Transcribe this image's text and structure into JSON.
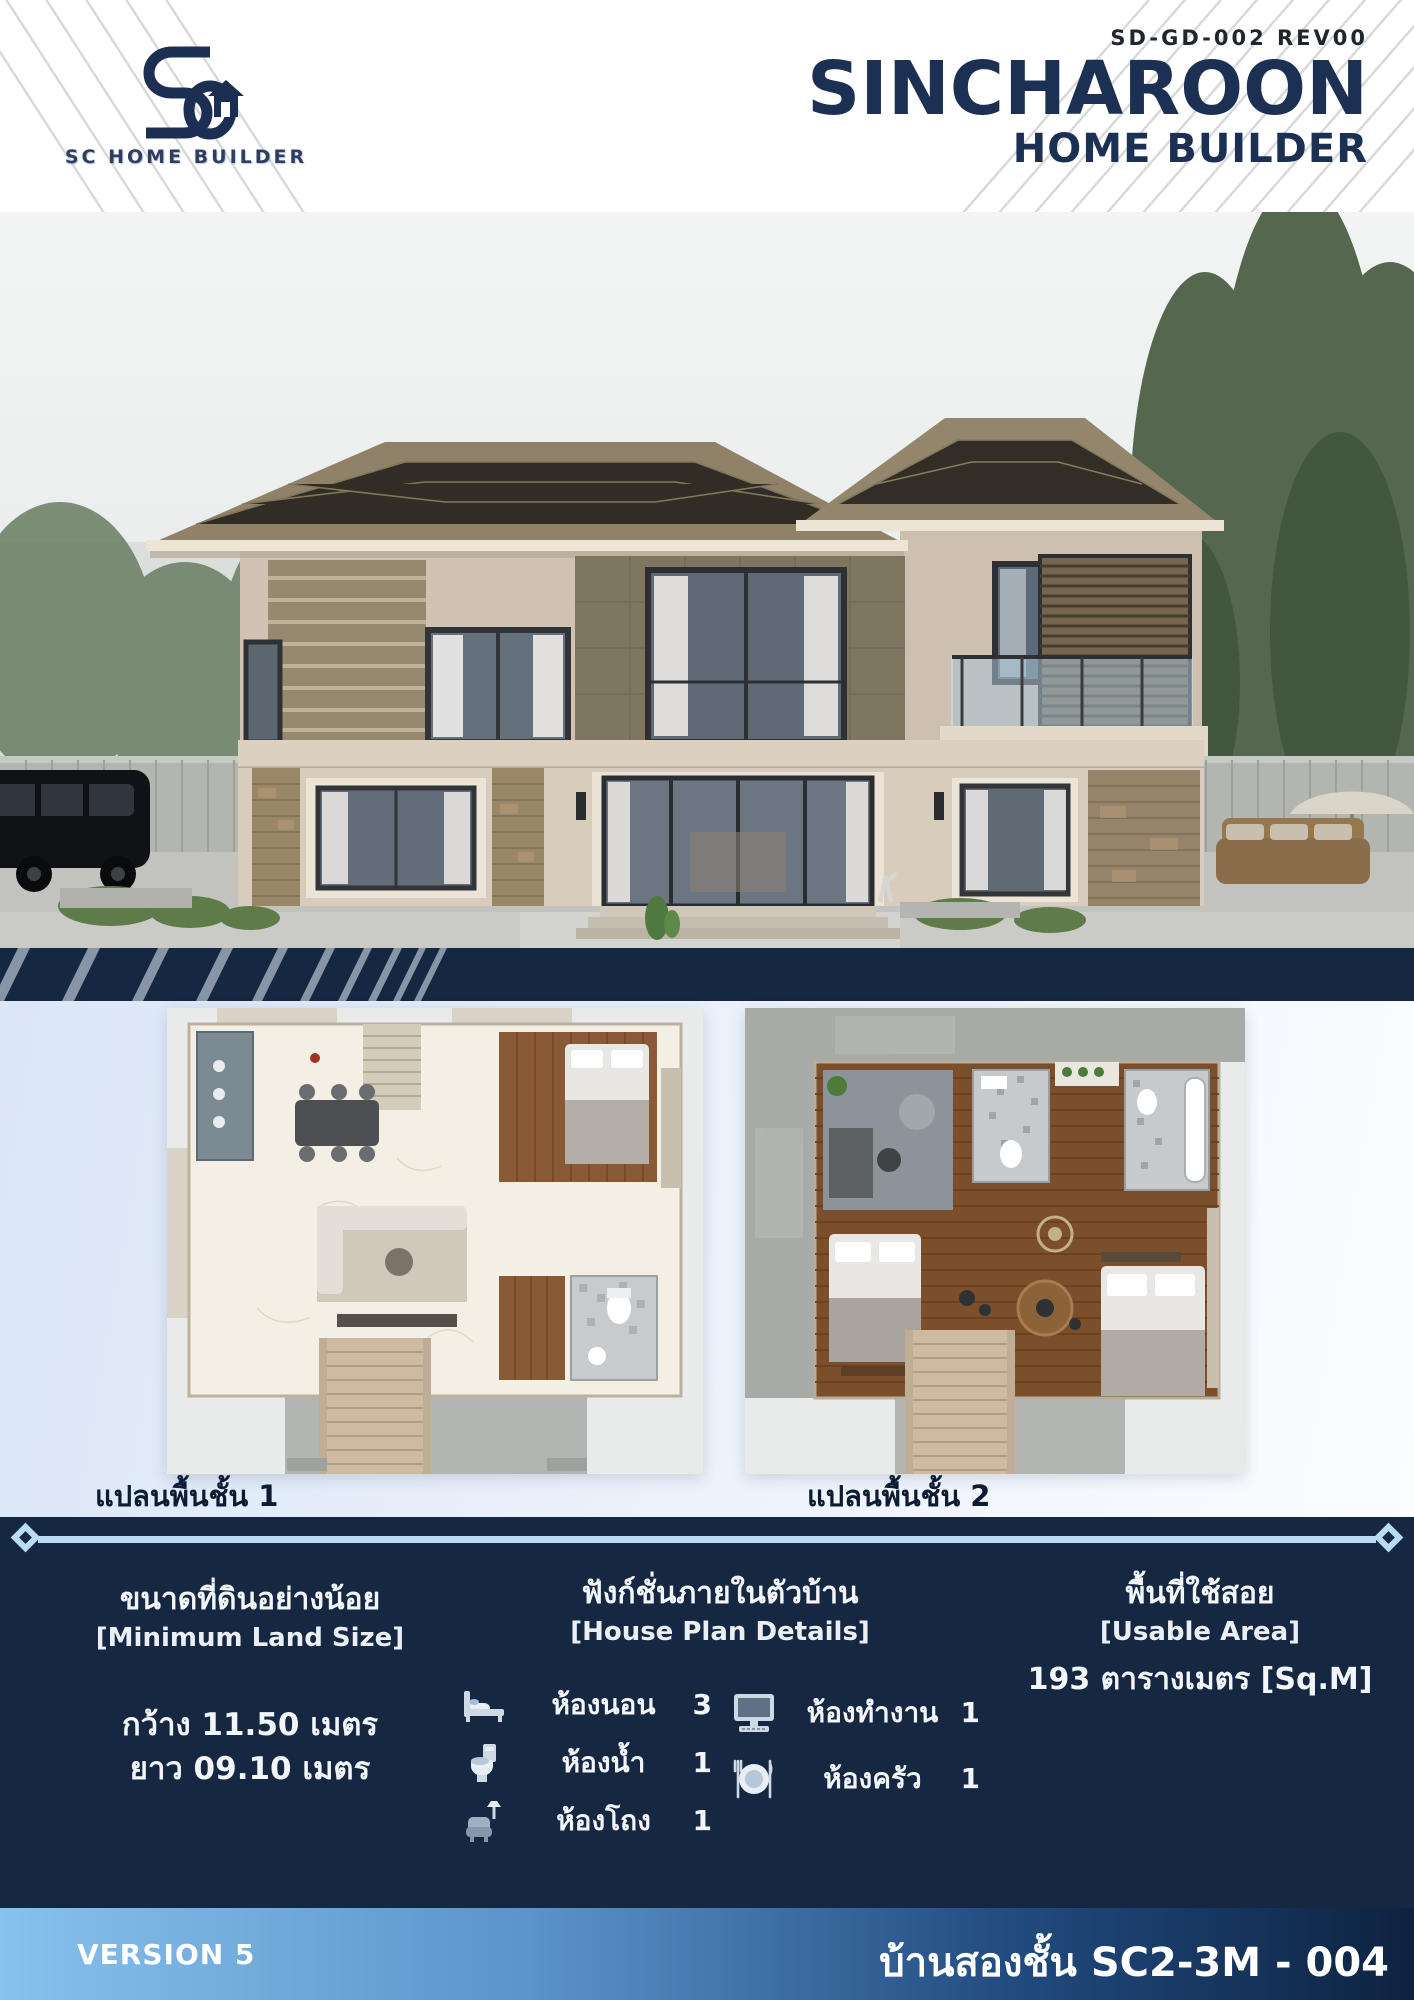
{
  "header": {
    "doc_code": "SD-GD-002 REV00",
    "brand_title": "SINCHAROON",
    "brand_subtitle": "HOME BUILDER",
    "logo_caption": "SC HOME BUILDER"
  },
  "plans": {
    "floor1_label": "แปลนพื้นชั้น 1",
    "floor2_label": "แปลนพื้นชั้น 2"
  },
  "specs": {
    "land": {
      "title_th": "ขนาดที่ดินอย่างน้อย",
      "title_en": "[Minimum Land Size]",
      "width_line": "กว้าง 11.50 เมตร",
      "length_line": "ยาว 09.10 เมตร"
    },
    "functions": {
      "title_th": "ฟังก์ชั่นภายในตัวบ้าน",
      "title_en": "[House Plan Details]",
      "items": [
        {
          "icon": "bed-icon",
          "label": "ห้องนอน",
          "count": "3"
        },
        {
          "icon": "toilet-icon",
          "label": "ห้องน้ำ",
          "count": "1"
        },
        {
          "icon": "sofa-icon",
          "label": "ห้องโถง",
          "count": "1"
        },
        {
          "icon": "computer-icon",
          "label": "ห้องทำงาน",
          "count": "1"
        },
        {
          "icon": "kitchen-icon",
          "label": "ห้องครัว",
          "count": "1"
        }
      ]
    },
    "area": {
      "title_th": "พื้นที่ใช้สอย",
      "title_en": "[Usable Area]",
      "value": "193 ตารางเมตร [Sq.M]"
    }
  },
  "footer": {
    "version": "VERSION 5",
    "model": "บ้านสองชั้น SC2-3M - 004"
  },
  "colors": {
    "navy": "#152741",
    "accent_light_blue": "#b9dcf4",
    "title_navy": "#1c3054",
    "footer_gradient_start": "#87c1ed",
    "footer_gradient_end": "#0d2240"
  }
}
